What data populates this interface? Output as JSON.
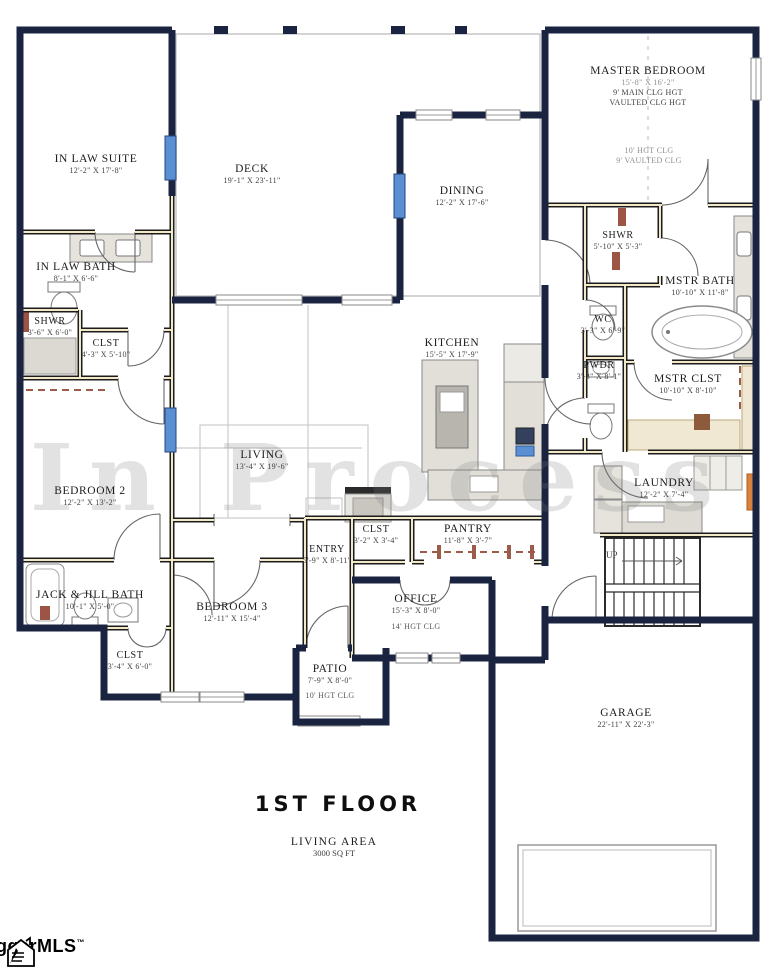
{
  "watermark": "In Process",
  "title": {
    "floor": "1ST FLOOR",
    "area_label": "LIVING AREA",
    "area_value": "3000 SQ FT"
  },
  "logo": {
    "name": "ggarMLS",
    "trademark": "™"
  },
  "colors": {
    "wall_exterior": "#1a2440",
    "wall_interior_core": "#f2e9c8",
    "window_blue": "#5b8fd4",
    "accent_brown": "#9c5545",
    "accent_orange": "#d8823f",
    "counter_gray": "#e2dfd8",
    "watermark_gray": "#7d7d7d"
  },
  "rooms": {
    "in_law_suite": {
      "name": "IN LAW SUITE",
      "dims": "12'-2\" X 17'-8\""
    },
    "deck": {
      "name": "DECK",
      "dims": "19'-1\" X 23'-11\""
    },
    "dining": {
      "name": "DINING",
      "dims": "12'-2\" X 17'-6\""
    },
    "master_bedroom": {
      "name": "MASTER BEDROOM",
      "dims": "15'-8\" X 16'-2\"",
      "note1": "9' MAIN CLG HGT",
      "note2": "VAULTED CLG HGT"
    },
    "master_zone": {
      "note1": "10' HGT CLG",
      "note2": "9' VAULTED CLG"
    },
    "shwr_master": {
      "name": "SHWR",
      "dims": "5'-10\" X 5'-3\""
    },
    "mstr_bath": {
      "name": "MSTR BATH",
      "dims": "10'-10\" X 11'-8\""
    },
    "wc": {
      "name": "WC",
      "dims": "3'-3\" X 6'-9\""
    },
    "pwdr": {
      "name": "PWDR",
      "dims": "3'-3\" X 8'-1\""
    },
    "mstr_clst": {
      "name": "MSTR CLST",
      "dims": "10'-10\" X 8'-10\""
    },
    "in_law_bath": {
      "name": "IN LAW BATH",
      "dims": "8'-1\" X 6'-6\""
    },
    "shwr_inlaw": {
      "name": "SHWR",
      "dims": "3'-6\" X 6'-0\""
    },
    "clst_inlaw": {
      "name": "CLST",
      "dims": "4'-3\" X 5'-10\""
    },
    "kitchen": {
      "name": "KITCHEN",
      "dims": "15'-5\" X 17'-9\""
    },
    "living": {
      "name": "LIVING",
      "dims": "13'-4\" X 19'-6\""
    },
    "bedroom2": {
      "name": "BEDROOM 2",
      "dims": "12'-2\" X 13'-2\""
    },
    "laundry": {
      "name": "LAUNDRY",
      "dims": "12'-2\" X 7'-4\""
    },
    "jack_jill_bath": {
      "name": "JACK & JILL BATH",
      "dims": "10'-1\" X 5'-0\""
    },
    "bedroom3": {
      "name": "BEDROOM 3",
      "dims": "12'-11\" X 15'-4\""
    },
    "clst_bed3": {
      "name": "CLST",
      "dims": "3'-4\" X 6'-0\""
    },
    "entry": {
      "name": "ENTRY",
      "dims": "5'-9\" X 8'-11\""
    },
    "clst_entry": {
      "name": "CLST",
      "dims": "3'-2\" X 3'-4\""
    },
    "pantry": {
      "name": "PANTRY",
      "dims": "11'-8\" X 3'-7\""
    },
    "office": {
      "name": "OFFICE",
      "dims": "15'-3\" X 8'-0\"",
      "note1": "14' HGT CLG"
    },
    "patio": {
      "name": "PATIO",
      "dims": "7'-9\" X 8'-0\"",
      "note1": "10' HGT CLG"
    },
    "garage": {
      "name": "GARAGE",
      "dims": "22'-11\" X 22'-3\""
    },
    "stairs": {
      "up": "UP"
    }
  }
}
